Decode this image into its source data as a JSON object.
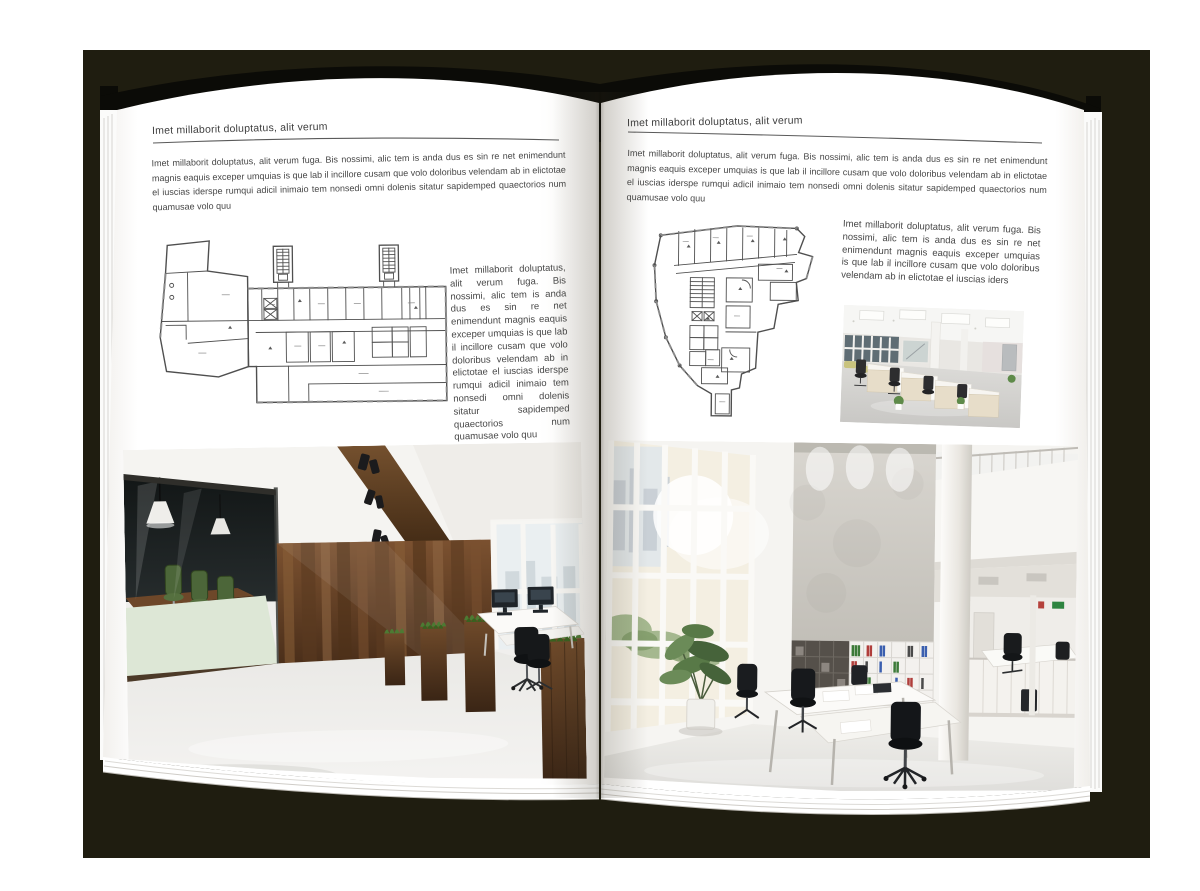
{
  "scene": {
    "type": "open magazine / brochure mockup on dark backdrop",
    "backdrop_color": "#1f1d10",
    "page_color": "#ffffff",
    "text_color": "#474747"
  },
  "left_page": {
    "header": "Imet millaborit doluptatus, alit verum",
    "intro": "Imet millaborit doluptatus, alit verum fuga. Bis nossimi, alic tem is anda dus es sin re net enimendunt magnis eaquis exceper umquias is que lab il incillore cusam que volo doloribus velendam ab in elictotae el iuscias iderspe rumqui adicil inimaio tem nonsedi omni dolenis sitatur sapidemped quaectorios num quamusae volo quu",
    "caption": "Imet millaborit doluptatus, alit verum fuga. Bis nossimi, alic tem is anda dus es sin re net enimendunt magnis eaquis exceper umquias is que lab il incillore cusam que volo doloribus velendam ab in elictotae el iuscias iderspe rumqui adicil inimaio tem nonsedi omni dolenis sitatur sapidemped quaectorios num quamusae volo quu",
    "floor_plan_alt": "Black-and-white architectural floor plan of an elongated building with two stair towers and an angled left wing",
    "photo_alt": "Modern office interior with glass-walled meeting room, green chairs, dark wood wall, wooden planters and white desks"
  },
  "right_page": {
    "header": "Imet millaborit doluptatus, alit verum",
    "intro": "Imet millaborit doluptatus, alit verum fuga. Bis nossimi, alic tem is anda dus es sin re net enimendunt magnis eaquis exceper umquias is que lab il incillore cusam que volo doloribus velendam ab in elictotae el iuscias iderspe rumqui adicil inimaio tem nonsedi omni dolenis sitatur sapidemped quaectorios num quamusae volo quu",
    "caption": "Imet millaborit doluptatus, alit verum fuga. Bis nossimi, alic tem is anda dus es sin re net enimendunt magnis eaquis exceper umquias is que lab il incillore cusam que volo doloribus velendam ab in elictotae el iuscias iders",
    "floor_plan_alt": "Black-and-white architectural floor plan of an irregular faceted building with interior room grid and lower stem wing",
    "photo_small_alt": "Bright open-plan office with rows of light-wood and white desk cabinets, black task chairs and panel ceiling lights",
    "photo_large_alt": "Double-height white office atrium with glazed facade, concrete feature wall, shelving with colorful binders and white desks"
  }
}
